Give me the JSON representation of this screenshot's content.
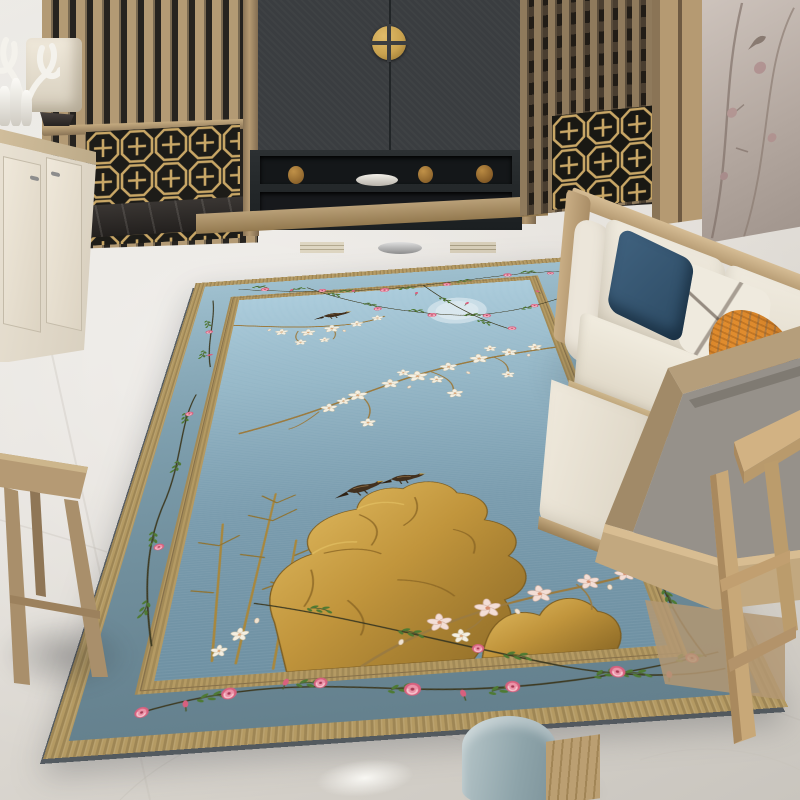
{
  "scene": {
    "type": "interior-photo",
    "description": "Chinoiserie living room with a blue floral area rug on a white marble floor",
    "objects": [
      "wood-slat-screen",
      "lattice-panel",
      "tv-cabinet",
      "brass-knob",
      "console-table",
      "sideboard",
      "antler-sculpture",
      "table-lamp",
      "vases",
      "mural-wall",
      "sofa",
      "throw-pillows",
      "armchair",
      "side-table",
      "wood-stool",
      "ottoman",
      "area-rug"
    ]
  },
  "rug": {
    "style": "chinoiserie",
    "motifs": [
      "magnolia-branches",
      "rose-vines",
      "golden-scholar-rock",
      "bamboo",
      "perched-birds",
      "full-moon"
    ],
    "colors": {
      "field": "#9fc0d2",
      "band": "#7695a4",
      "trim": "#b49a63",
      "rose": "#dd6f8a",
      "leaf": "#4e7a33",
      "gold": "#c39a44"
    }
  },
  "palette": {
    "floor": "#eceae5",
    "floor_dark": "#c9c5be",
    "baseboard": "#3a3633",
    "wood": "#b39a74",
    "wood_dark": "#8a7456",
    "slat_gap": "#26231f",
    "cabinet": "#3a3d40",
    "cabinet_dark": "#212527",
    "brass": "#c9a24f",
    "cream": "#ece5d7",
    "mural": "#b3a79f",
    "sofa_cream": "#ece6da",
    "pillow_navy": "#2c4a63",
    "pillow_navy2": "#27435c",
    "pillow_orange": "#e08c2e",
    "chair_gray": "#96918a",
    "rug_trim": "#b49a63",
    "rug_band_top": "#9fc0cf",
    "rug_band_bottom": "#64808d",
    "rug_field_top": "#aacbdb",
    "rug_field_bottom": "#6f91a3",
    "rose": "#dd6f8a",
    "leaf": "#4e7a33",
    "gold": "#c39a44",
    "branch": "#9b7b40"
  }
}
